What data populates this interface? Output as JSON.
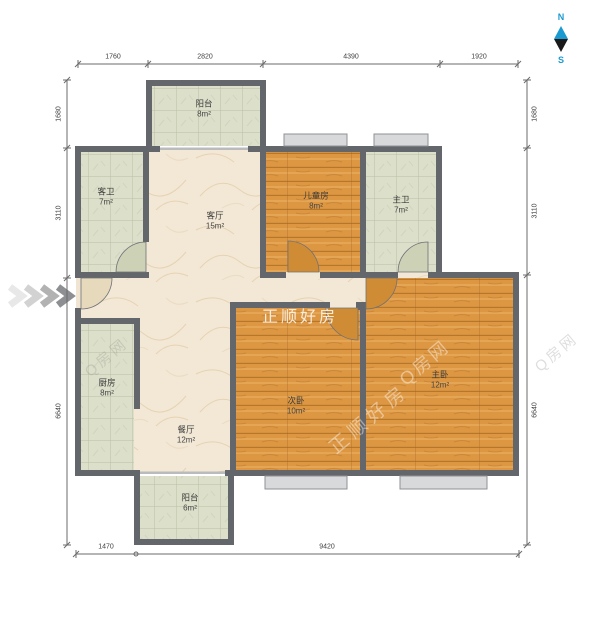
{
  "compass": {
    "north": "N",
    "south": "S",
    "needle_top_color": "#1b9ad2",
    "needle_bottom_color": "#1a1a1a"
  },
  "rooms": [
    {
      "id": "balcony-top",
      "name": "阳台",
      "area": "8m²"
    },
    {
      "id": "guest-bath",
      "name": "客卫",
      "area": "7m²"
    },
    {
      "id": "living-room",
      "name": "客厅",
      "area": "15m²"
    },
    {
      "id": "kids-room",
      "name": "儿童房",
      "area": "8m²"
    },
    {
      "id": "master-bath",
      "name": "主卫",
      "area": "7m²"
    },
    {
      "id": "kitchen",
      "name": "厨房",
      "area": "8m²"
    },
    {
      "id": "dining-room",
      "name": "餐厅",
      "area": "12m²"
    },
    {
      "id": "second-bedroom",
      "name": "次卧",
      "area": "10m²"
    },
    {
      "id": "master-bedroom",
      "name": "主卧",
      "area": "12m²"
    },
    {
      "id": "balcony-bottom",
      "name": "阳台",
      "area": "6m²"
    }
  ],
  "dimensions": {
    "top": [
      "1760",
      "2820",
      "4390",
      "1920"
    ],
    "left": [
      "1680",
      "3110",
      "6640"
    ],
    "right": [
      "1680",
      "3110",
      "6640"
    ],
    "bottom": [
      "1470",
      "9420"
    ]
  },
  "watermarks": {
    "brand": "正顺好房",
    "site": "Q房网"
  },
  "colors": {
    "wall": "#63666b",
    "wood_floor": "#dd9743",
    "tile_floor": "#dcdfc9",
    "marble_floor": "#f2e8d5",
    "window": "#d8d9db"
  }
}
